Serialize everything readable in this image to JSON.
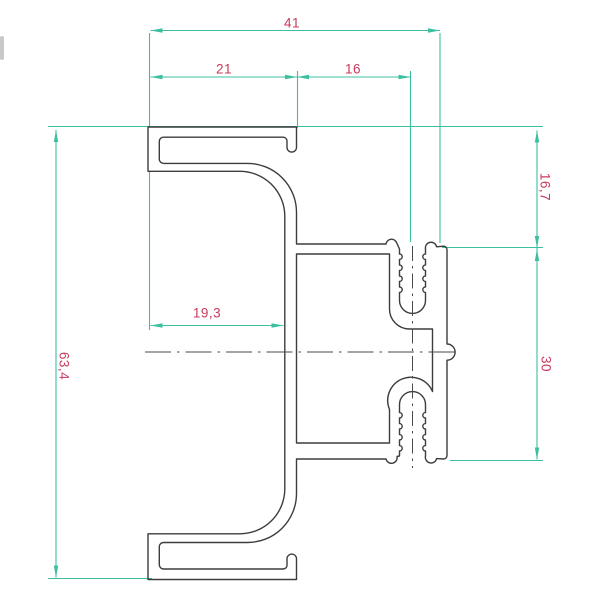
{
  "drawing": {
    "type": "technical-cross-section",
    "colors": {
      "dimension_lines": "#3cbfa0",
      "dimension_text": "#c83a5c",
      "profile_lines": "#3d3d3d"
    },
    "dimensions": {
      "total_width": "41",
      "flange_width": "21",
      "boss_offset": "16",
      "top_depth": "16,7",
      "boss_span": "30",
      "total_height": "63,4",
      "opening_depth": "19,3"
    }
  }
}
